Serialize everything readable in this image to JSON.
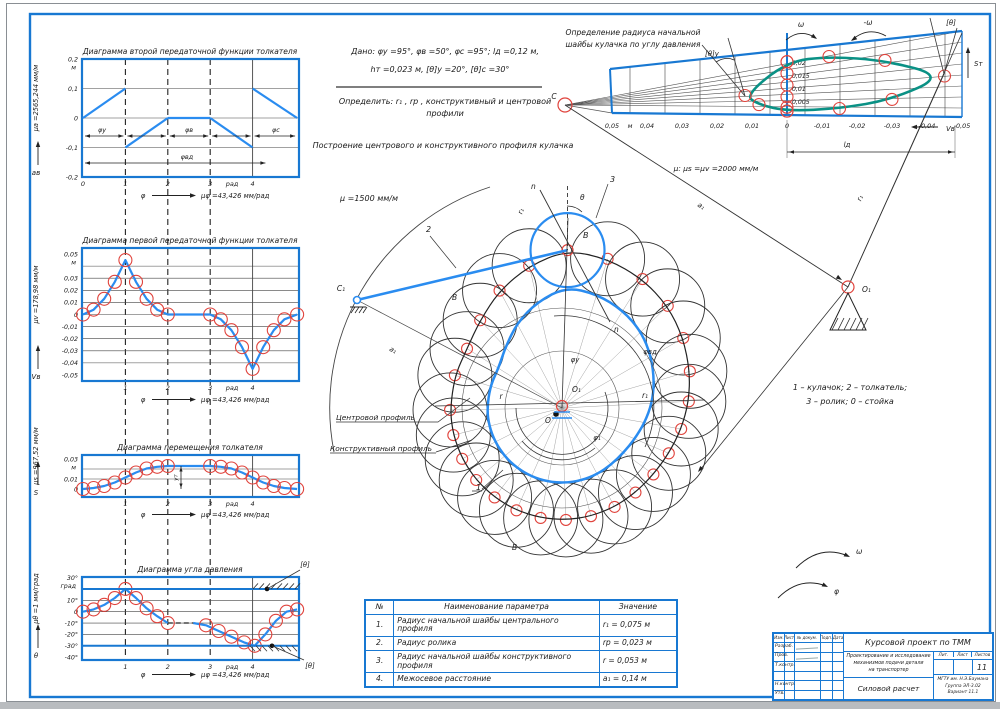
{
  "given": {
    "line1": "Дано: φу =95°, φв =50°, φс =95°; lд =0,12 м,",
    "line2": "hт =0,023 м, [θ]у =20°, [θ]с =30°",
    "task1": "Определить: r₁ , rр , конструктивный и центровой",
    "task2": "профили",
    "heading": "Построение центрового и конструктивного профиля кулачка"
  },
  "top_right": {
    "title1": "Определение радиуса начальной",
    "title2": "шайбы кулачка по углу давления",
    "scale": "μ: μs =μv =2000 мм/м",
    "omega": "ω",
    "minus_omega": "-ω",
    "theta_u": "[θ]у",
    "theta": "[θ]",
    "s_axis": "Sт",
    "v_axis": "Vв",
    "c_label": "C",
    "o_label": "O₁",
    "a1_label": "a₁",
    "r_label": "r₁",
    "ld_label": "lд"
  },
  "cam": {
    "scale": "μ =1500 мм/м",
    "c1": "C₁",
    "b_top": "B",
    "b_left": "B",
    "b_bottom": "B",
    "o1": "O₁",
    "o": "O",
    "n1": "n",
    "n2": "n",
    "theta": "θ",
    "num1": "1",
    "num2": "2",
    "num3": "3",
    "r1_rot": "r₁",
    "phi_u": "φу",
    "phi_vd": "φвд",
    "phi_1": "φ₁",
    "r": "r",
    "r1": "r₁",
    "a1": "a₁",
    "centr": "Центровой профиль",
    "konstr": "Конструктивный профиль",
    "legend1": "1 – кулачок; 2 – толкатель;",
    "legend2": "3 – ролик; 0 – стойка",
    "omega2": "ω",
    "phi2": "φ"
  },
  "table": {
    "headers": [
      "№",
      "Наименование параметра",
      "Значение"
    ],
    "rows": [
      [
        "1.",
        "Радиус начальной шайбы центрального профиля",
        "r₁ = 0,075 м"
      ],
      [
        "2.",
        "Радиус ролика",
        "rр = 0,023 м"
      ],
      [
        "3.",
        "Радиус начальной шайбы конструктивного профиля",
        "r = 0,053 м"
      ],
      [
        "4.",
        "Межосевое расстояние",
        "a₁ = 0,14 м"
      ]
    ]
  },
  "titleblock": {
    "project": "Курсовой проект по ТММ",
    "desc": [
      "Проектирование и исследование",
      "механизмов подачи детали",
      "на транспортер"
    ],
    "doc": "Силовой расчет",
    "lit": "Лит.",
    "list": "Лист",
    "listov": "Листов",
    "sheet_num": "11",
    "org": [
      "МГТУ им. Н.Э.Баумана",
      "Группа ЭЛ-3.02",
      "Вариант 11.1"
    ],
    "head_cols": [
      "Изм.",
      "Лист",
      "№ докум.",
      "Подп.",
      "Дата"
    ],
    "row_labels": [
      "Разраб.",
      "Пров.",
      "Т.контр.",
      "",
      "Н.контр.",
      "Утв."
    ]
  },
  "chart_data": [
    {
      "type": "line",
      "id": "p1",
      "title": "Диаграмма второй передаточной функции толкателя",
      "scale_label": "μa =2565,244 мм/м",
      "axis_letter": "aв",
      "unit": "м",
      "xlabel": "φ",
      "xunit": "рад",
      "xscale_label": "μφ =43,426 мм/рад",
      "ytick_vals": [
        0.2,
        0.1,
        0,
        -0.1,
        -0.2
      ],
      "ytick_labels": [
        "0,2",
        "0,1",
        "0",
        "-0,1",
        "-0,2"
      ],
      "ygrid": [
        0.1,
        0,
        -0.1
      ],
      "xtick_vals": [
        0,
        1,
        2,
        3,
        4
      ],
      "xtick_labels": [
        "0",
        "1",
        "2",
        "3",
        "4"
      ],
      "ylim": [
        -0.2,
        0.2
      ],
      "xlim": [
        0,
        5.1
      ],
      "segments": [
        [
          [
            0,
            0
          ],
          [
            1,
            0.1
          ]
        ],
        [
          [
            1,
            -0.1
          ],
          [
            2,
            0
          ]
        ],
        [
          [
            2,
            0
          ],
          [
            3,
            0
          ]
        ],
        [
          [
            3,
            0
          ],
          [
            4,
            -0.1
          ]
        ],
        [
          [
            4,
            0.1
          ],
          [
            5.05,
            0
          ]
        ]
      ],
      "phase_labels": [
        "φу",
        "φв",
        "φс"
      ],
      "phase_long_label": "φвд"
    },
    {
      "type": "line",
      "id": "p2",
      "title": "Диаграмма первой передаточной функции толкателя",
      "scale_label": "μv =178,98 мм/м",
      "axis_letter": "Vв",
      "unit": "м",
      "xlabel": "φ",
      "xunit": "рад",
      "xscale_label": "μφ =43,426 мм/рад",
      "ytick_vals": [
        0.05,
        0.03,
        0.02,
        0.01,
        0,
        -0.01,
        -0.02,
        -0.03,
        -0.04,
        -0.05
      ],
      "ytick_labels": [
        "0,05",
        "0,03",
        "0,02",
        "0,01",
        "0",
        "-0,01",
        "-0,02",
        "-0,03",
        "-0,04",
        "-0,05"
      ],
      "ygrid": [
        0.04,
        0.03,
        0.02,
        0.01,
        0,
        -0.01,
        -0.02,
        -0.03,
        -0.04
      ],
      "xtick_vals": [
        1,
        2,
        3,
        4
      ],
      "xtick_labels": [
        "1",
        "2",
        "3",
        "4"
      ],
      "ylim": [
        -0.055,
        0.055
      ],
      "points": [
        [
          0,
          0
        ],
        [
          0.25,
          0.004
        ],
        [
          0.5,
          0.013
        ],
        [
          0.75,
          0.027
        ],
        [
          1,
          0.045
        ],
        [
          1.25,
          0.027
        ],
        [
          1.5,
          0.013
        ],
        [
          1.75,
          0.004
        ],
        [
          2,
          0
        ],
        [
          2.5,
          0
        ],
        [
          3,
          0
        ],
        [
          3.25,
          -0.004
        ],
        [
          3.5,
          -0.013
        ],
        [
          3.75,
          -0.027
        ],
        [
          4,
          -0.045
        ],
        [
          4.25,
          -0.027
        ],
        [
          4.5,
          -0.013
        ],
        [
          4.75,
          -0.004
        ],
        [
          5.05,
          0
        ]
      ],
      "markers": [
        [
          0,
          0
        ],
        [
          0.25,
          0.004
        ],
        [
          0.5,
          0.013
        ],
        [
          0.75,
          0.027
        ],
        [
          1,
          0.045
        ],
        [
          1.25,
          0.027
        ],
        [
          1.5,
          0.013
        ],
        [
          1.75,
          0.004
        ],
        [
          2,
          0
        ],
        [
          3,
          0
        ],
        [
          3.25,
          -0.004
        ],
        [
          3.5,
          -0.013
        ],
        [
          3.75,
          -0.027
        ],
        [
          4,
          -0.045
        ],
        [
          4.25,
          -0.027
        ],
        [
          4.5,
          -0.013
        ],
        [
          4.75,
          -0.004
        ],
        [
          5.05,
          0
        ]
      ]
    },
    {
      "type": "line",
      "id": "p3",
      "title": "Диаграмма перемещения толкателя",
      "scale_label": "μs =967,52 мм/м",
      "axis_letter": "S",
      "unit": "м",
      "xlabel": "φ",
      "xunit": "рад",
      "xscale_label": "μφ =43,426 мм/рад",
      "ytick_vals": [
        0.03,
        0.01,
        0
      ],
      "ytick_labels": [
        "0,03",
        "0,01",
        "0"
      ],
      "ygrid": [
        0.02,
        0.01
      ],
      "xtick_vals": [
        1,
        2,
        3,
        4
      ],
      "xtick_labels": [
        "1",
        "2",
        "3",
        "4"
      ],
      "ylim": [
        -0.008,
        0.034
      ],
      "ymax_label": "yт",
      "points": [
        [
          0,
          0
        ],
        [
          0.25,
          0.001
        ],
        [
          0.5,
          0.003
        ],
        [
          0.75,
          0.0065
        ],
        [
          1,
          0.0115
        ],
        [
          1.25,
          0.0165
        ],
        [
          1.5,
          0.0205
        ],
        [
          1.75,
          0.0222
        ],
        [
          2,
          0.023
        ],
        [
          2.5,
          0.023
        ],
        [
          3,
          0.023
        ],
        [
          3.25,
          0.0222
        ],
        [
          3.5,
          0.0205
        ],
        [
          3.75,
          0.0165
        ],
        [
          4,
          0.0115
        ],
        [
          4.25,
          0.0065
        ],
        [
          4.5,
          0.003
        ],
        [
          4.75,
          0.001
        ],
        [
          5.05,
          0
        ]
      ],
      "markers": [
        [
          0,
          0
        ],
        [
          0.25,
          0.001
        ],
        [
          0.5,
          0.003
        ],
        [
          0.75,
          0.0065
        ],
        [
          1,
          0.0115
        ],
        [
          1.25,
          0.0165
        ],
        [
          1.5,
          0.0205
        ],
        [
          1.75,
          0.0222
        ],
        [
          2,
          0.023
        ],
        [
          3,
          0.023
        ],
        [
          3.25,
          0.0222
        ],
        [
          3.5,
          0.0205
        ],
        [
          3.75,
          0.0165
        ],
        [
          4,
          0.0115
        ],
        [
          4.25,
          0.0065
        ],
        [
          4.5,
          0.003
        ],
        [
          4.75,
          0.001
        ],
        [
          5.05,
          0
        ]
      ]
    },
    {
      "type": "line",
      "id": "p4",
      "title": "Диаграмма угла давления",
      "scale_label": "μθ =1 мм/град",
      "axis_letter": "θ",
      "unit": "град",
      "xlabel": "φ",
      "xunit": "рад",
      "xscale_label": "μφ =43,426 мм/рад",
      "ytick_vals": [
        30,
        10,
        0,
        -10,
        -20,
        -30,
        -40
      ],
      "ytick_labels": [
        "30°",
        "10°",
        "0",
        "-10°",
        "-20°",
        "-30°",
        "-40°"
      ],
      "ygrid": [
        20,
        10,
        0,
        -10,
        -20,
        -30
      ],
      "xtick_vals": [
        1,
        2,
        3,
        4
      ],
      "xtick_labels": [
        "1",
        "2",
        "3",
        "4"
      ],
      "ylim": [
        -42.5,
        30.5
      ],
      "limits": {
        "upper": 20,
        "lower": -30,
        "label": "[θ]"
      },
      "solid1": [
        [
          0,
          0
        ],
        [
          0.25,
          2
        ],
        [
          0.5,
          6
        ],
        [
          0.75,
          12
        ],
        [
          1,
          20
        ],
        [
          1.25,
          12
        ],
        [
          1.5,
          3
        ],
        [
          1.75,
          -4
        ],
        [
          2,
          -10
        ]
      ],
      "dashed": [
        [
          2,
          -10
        ],
        [
          2.6,
          -10
        ]
      ],
      "solid2": [
        [
          2.6,
          -10
        ],
        [
          2.9,
          -12
        ],
        [
          3.2,
          -17
        ],
        [
          3.5,
          -22
        ],
        [
          3.8,
          -27
        ],
        [
          4.05,
          -30
        ],
        [
          4.3,
          -20
        ],
        [
          4.55,
          -8
        ],
        [
          4.8,
          0
        ],
        [
          5.05,
          2
        ]
      ],
      "markers": [
        [
          0,
          0
        ],
        [
          0.25,
          2
        ],
        [
          0.5,
          6
        ],
        [
          0.75,
          12
        ],
        [
          1,
          20
        ],
        [
          1.25,
          12
        ],
        [
          1.5,
          3
        ],
        [
          1.75,
          -4
        ],
        [
          2,
          -10
        ],
        [
          2.9,
          -12
        ],
        [
          3.2,
          -17
        ],
        [
          3.5,
          -22
        ],
        [
          3.8,
          -27
        ],
        [
          4.05,
          -30
        ],
        [
          4.3,
          -20
        ],
        [
          4.55,
          -8
        ],
        [
          4.8,
          0
        ],
        [
          5.05,
          2
        ]
      ]
    },
    {
      "type": "line",
      "id": "phase",
      "title": "Фазовый портрет Sт(Vв)",
      "xlabel": "Vв",
      "ylabel": "Sт",
      "unit": "м",
      "xtick_vals": [
        0.05,
        0.04,
        0.03,
        0.02,
        0.01,
        0,
        -0.01,
        -0.02,
        -0.03,
        -0.04,
        -0.05
      ],
      "xtick_labels": [
        "0,05",
        "0,04",
        "0,03",
        "0,02",
        "0,01",
        "0",
        "-0,01",
        "-0,02",
        "-0,03",
        "-0,04",
        "-0,05"
      ],
      "ytick_vals": [
        0.02,
        0.015,
        0.01,
        0.005
      ],
      "ytick_labels": [
        "0,02",
        "0,015",
        "0,01",
        "0,005"
      ],
      "curve": [
        [
          0.012,
          0.0075
        ],
        [
          0.0,
          0.0205
        ],
        [
          -0.012,
          0.0225
        ],
        [
          -0.028,
          0.021
        ],
        [
          -0.045,
          0.015
        ],
        [
          -0.03,
          0.006
        ],
        [
          -0.015,
          0.0025
        ],
        [
          0.0,
          0.0015
        ],
        [
          0.008,
          0.004
        ]
      ],
      "axis_points": [
        [
          0,
          0.0205
        ],
        [
          0,
          0.016
        ],
        [
          0,
          0.0115
        ],
        [
          0,
          0.007
        ],
        [
          0,
          0.003
        ],
        [
          0,
          0.0015
        ]
      ]
    }
  ]
}
